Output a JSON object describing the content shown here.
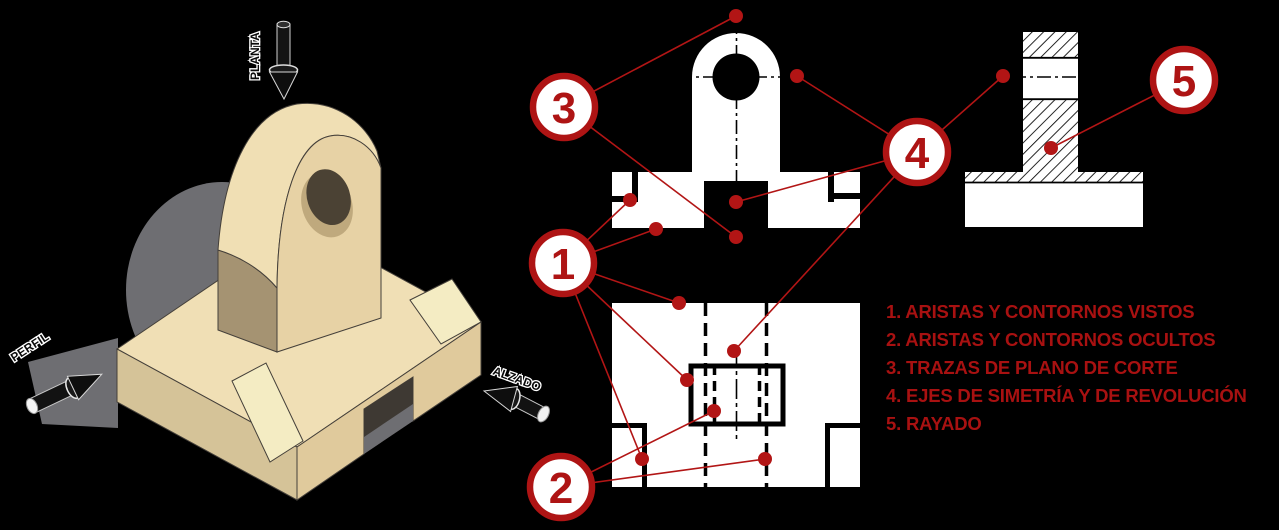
{
  "colors": {
    "background": "#000000",
    "annotation_red": "#AE1414",
    "leader_red": "#B21515",
    "legend_red": "#A81111",
    "drawing_white": "#FFFFFF",
    "drawing_black": "#000000",
    "model_top": "#F0DFB5",
    "model_front": "#E0CA9C",
    "model_side": "#A59372",
    "model_chamfer": "#F4ECC3",
    "model_shadow": "#6E6E72"
  },
  "view_labels": {
    "planta": "PLANTA",
    "perfil": "PERFIL",
    "alzado": "ALZADO"
  },
  "annotations": {
    "circles": [
      {
        "label": "3"
      },
      {
        "label": "1"
      },
      {
        "label": "2"
      },
      {
        "label": "4"
      },
      {
        "label": "5"
      }
    ]
  },
  "legend": {
    "items": [
      "1. ARISTAS Y CONTORNOS VISTOS",
      "2. ARISTAS Y CONTORNOS OCULTOS",
      "3. TRAZAS DE PLANO DE CORTE",
      "4. EJES DE SIMETRÍA Y DE REVOLUCIÓN",
      "5. RAYADO"
    ]
  }
}
